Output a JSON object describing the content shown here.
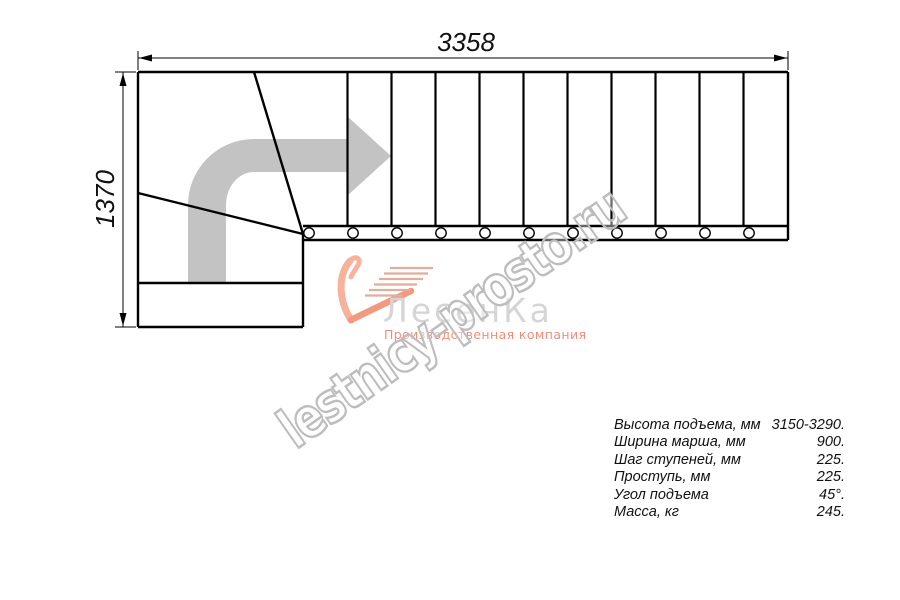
{
  "drawing": {
    "width_label": "3358",
    "height_label": "1370",
    "line_color": "#000000",
    "direction_arrow_color": "#c3c3c3",
    "tread_count_straight_flight": 11,
    "stringer_circle_count": 11
  },
  "logo": {
    "icon": "swoosh-stairs-icon",
    "brand": "ЛесенКа",
    "tagline": "Производственная компания",
    "colors": {
      "swoosh_light": "#f7b29d",
      "swoosh_dark": "#f19a80",
      "stair_lines": "#dfae9f",
      "brand_text": "#d5d5d5",
      "tagline_text": "#ee8f7e"
    }
  },
  "watermark": {
    "text": "lestnicy-prosto.ru",
    "stroke_color": "#bdbdbd"
  },
  "specs": {
    "rows": [
      {
        "label": "Высота подъема, мм",
        "value": "3150-3290."
      },
      {
        "label": "Ширина марша, мм",
        "value": "900."
      },
      {
        "label": "Шаг ступеней, мм",
        "value": "225."
      },
      {
        "label": "Проступь, мм",
        "value": "225."
      },
      {
        "label": "Угол подъема",
        "value": "45°."
      },
      {
        "label": "Масса, кг",
        "value": "245."
      }
    ]
  }
}
